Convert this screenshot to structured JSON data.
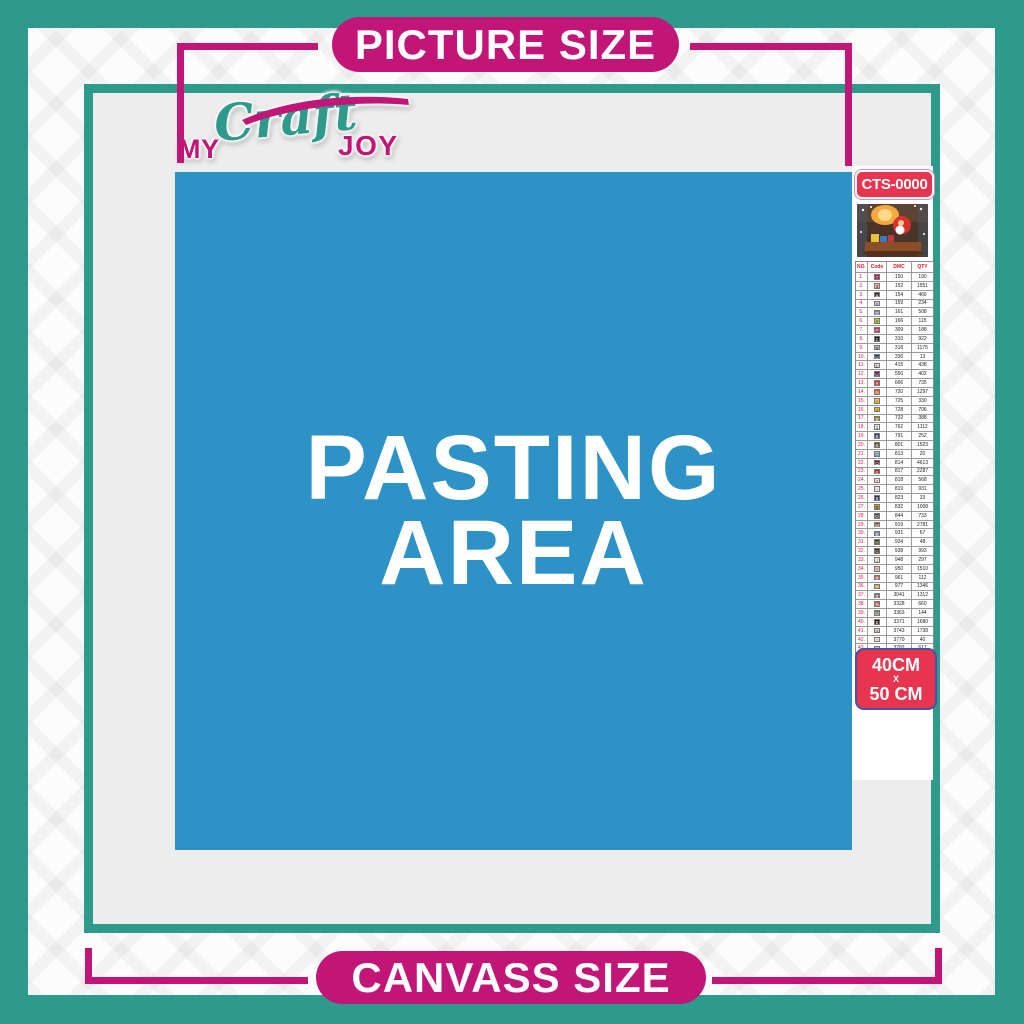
{
  "banner_top": {
    "label": "PICTURE SIZE"
  },
  "banner_bottom": {
    "label": "CANVASS SIZE"
  },
  "logo": {
    "my": "MY",
    "craft": "Craft",
    "joy": "JOY"
  },
  "pasting_area": {
    "line1": "PASTING",
    "line2": "AREA"
  },
  "sidebar": {
    "sku": "CTS-0000",
    "thumbnail_alt": "christmas-santa-sleigh-artwork",
    "size_box": {
      "line1": "40CM",
      "line2": "X",
      "line3": "50 CM"
    },
    "table": {
      "headers": [
        "NO.",
        "Code",
        "DMC",
        "QTY"
      ],
      "rows": [
        {
          "no": "1.",
          "sym": "T",
          "bg": "#a3134b",
          "fg": "#ffffff",
          "dmc": "150",
          "qty": "190"
        },
        {
          "no": "2.",
          "sym": "3",
          "bg": "#e9b3ae",
          "fg": "#5a2a33",
          "dmc": "152",
          "qty": "1551"
        },
        {
          "no": "3.",
          "sym": "a",
          "bg": "#57253e",
          "fg": "#ffffff",
          "dmc": "154",
          "qty": "466"
        },
        {
          "no": "4.",
          "sym": "X",
          "bg": "#c9cce0",
          "fg": "#555a77",
          "dmc": "159",
          "qty": "234"
        },
        {
          "no": "5.",
          "sym": "G",
          "bg": "#7f87ac",
          "fg": "#ffffff",
          "dmc": "161",
          "qty": "508"
        },
        {
          "no": "6.",
          "sym": "h",
          "bg": "#c5cf3c",
          "fg": "#4a4a10",
          "dmc": "166",
          "qty": "115"
        },
        {
          "no": "7.",
          "sym": "P",
          "bg": "#c22e53",
          "fg": "#ffffff",
          "dmc": "309",
          "qty": "188"
        },
        {
          "no": "8.",
          "sym": "E",
          "bg": "#0a0a0a",
          "fg": "#ffffff",
          "dmc": "310",
          "qty": "922"
        },
        {
          "no": "9.",
          "sym": "X",
          "bg": "#b0b1b3",
          "fg": "#3a3a3a",
          "dmc": "318",
          "qty": "1175"
        },
        {
          "no": "10.",
          "sym": "U",
          "bg": "#2a3c6e",
          "fg": "#ffffff",
          "dmc": "336",
          "qty": "13"
        },
        {
          "no": "11.",
          "sym": "L",
          "bg": "#d6d6da",
          "fg": "#3a3a3a",
          "dmc": "415",
          "qty": "438"
        },
        {
          "no": "12.",
          "sym": "U",
          "bg": "#611a56",
          "fg": "#ffffff",
          "dmc": "550",
          "qty": "402"
        },
        {
          "no": "13.",
          "sym": "#",
          "bg": "#e52c3c",
          "fg": "#ffffff",
          "dmc": "666",
          "qty": "735"
        },
        {
          "no": "14.",
          "sym": "N",
          "bg": "#e65d23",
          "fg": "#ffffff",
          "dmc": "720",
          "qty": "1297"
        },
        {
          "no": "15.",
          "sym": "A",
          "bg": "#ffc43c",
          "fg": "#6b4a00",
          "dmc": "725",
          "qty": "330"
        },
        {
          "no": "16.",
          "sym": "2",
          "bg": "#f0b83a",
          "fg": "#6b4a00",
          "dmc": "728",
          "qty": "706"
        },
        {
          "no": "17.",
          "sym": "S",
          "bg": "#9a8f22",
          "fg": "#ffffff",
          "dmc": "732",
          "qty": "388"
        },
        {
          "no": "18.",
          "sym": "1",
          "bg": "#e9e9eb",
          "fg": "#3a3a3a",
          "dmc": "762",
          "qty": "1112"
        },
        {
          "no": "19.",
          "sym": "B",
          "bg": "#3c3a75",
          "fg": "#ffffff",
          "dmc": "791",
          "qty": "252"
        },
        {
          "no": "20.",
          "sym": "B",
          "bg": "#6a4528",
          "fg": "#ffffff",
          "dmc": "801",
          "qty": "1523"
        },
        {
          "no": "21.",
          "sym": "O",
          "bg": "#a8c6de",
          "fg": "#2a4a66",
          "dmc": "813",
          "qty": "20"
        },
        {
          "no": "22.",
          "sym": "O",
          "bg": "#750b24",
          "fg": "#ffffff",
          "dmc": "814",
          "qty": "4613"
        },
        {
          "no": "23.",
          "sym": "E",
          "bg": "#c01f23",
          "fg": "#ffffff",
          "dmc": "817",
          "qty": "2287"
        },
        {
          "no": "24.",
          "sym": "7",
          "bg": "#ffdfdb",
          "fg": "#8a4a4a",
          "dmc": "818",
          "qty": "568"
        },
        {
          "no": "25.",
          "sym": "+",
          "bg": "#f9ebe9",
          "fg": "#8a5a5a",
          "dmc": "819",
          "qty": "931"
        },
        {
          "no": "26.",
          "sym": "B",
          "bg": "#22315f",
          "fg": "#ffffff",
          "dmc": "823",
          "qty": "33"
        },
        {
          "no": "27.",
          "sym": "B",
          "bg": "#c09c3f",
          "fg": "#4a3a00",
          "dmc": "832",
          "qty": "1008"
        },
        {
          "no": "28.",
          "sym": "O",
          "bg": "#4a4a4a",
          "fg": "#ffffff",
          "dmc": "844",
          "qty": "733"
        },
        {
          "no": "29.",
          "sym": "M",
          "bg": "#a6462a",
          "fg": "#ffffff",
          "dmc": "919",
          "qty": "2781"
        },
        {
          "no": "30.",
          "sym": "S",
          "bg": "#6f90ab",
          "fg": "#ffffff",
          "dmc": "931",
          "qty": "67"
        },
        {
          "no": "31.",
          "sym": "H",
          "bg": "#3a4020",
          "fg": "#ffffff",
          "dmc": "934",
          "qty": "48"
        },
        {
          "no": "32.",
          "sym": "G",
          "bg": "#3c2613",
          "fg": "#ffffff",
          "dmc": "938",
          "qty": "993"
        },
        {
          "no": "33.",
          "sym": "J",
          "bg": "#fde9da",
          "fg": "#8a5a3a",
          "dmc": "948",
          "qty": "297"
        },
        {
          "no": "34.",
          "sym": "*",
          "bg": "#e6c0aa",
          "fg": "#7a4a2a",
          "dmc": "950",
          "qty": "1510"
        },
        {
          "no": "35.",
          "sym": "#",
          "bg": "#d06b80",
          "fg": "#ffffff",
          "dmc": "961",
          "qty": "112"
        },
        {
          "no": "36.",
          "sym": "T",
          "bg": "#dc9e58",
          "fg": "#ffffff",
          "dmc": "977",
          "qty": "1346"
        },
        {
          "no": "37.",
          "sym": "2",
          "bg": "#94788b",
          "fg": "#ffffff",
          "dmc": "3041",
          "qty": "1312"
        },
        {
          "no": "38.",
          "sym": "%",
          "bg": "#c65966",
          "fg": "#ffffff",
          "dmc": "3328",
          "qty": "660"
        },
        {
          "no": "39.",
          "sym": "U",
          "bg": "#77865e",
          "fg": "#ffffff",
          "dmc": "3363",
          "qty": "144"
        },
        {
          "no": "40.",
          "sym": "B",
          "bg": "#241307",
          "fg": "#ffffff",
          "dmc": "3371",
          "qty": "1680"
        },
        {
          "no": "41.",
          "sym": "Y",
          "bg": "#dcd1dc",
          "fg": "#4a3a4a",
          "dmc": "3743",
          "qty": "1738"
        },
        {
          "no": "42.",
          "sym": "^",
          "bg": "#ffeee3",
          "fg": "#8a6a4a",
          "dmc": "3770",
          "qty": "40"
        },
        {
          "no": "43.",
          "sym": "V",
          "bg": "#d4bfa5",
          "fg": "#5a4a2a",
          "dmc": "3782",
          "qty": "617"
        },
        {
          "no": "44.",
          "sym": "2",
          "bg": "#dfe269",
          "fg": "#4a5a10",
          "dmc": "3819",
          "qty": "119"
        },
        {
          "no": "45.",
          "sym": "/",
          "bg": "#fdf6d3",
          "fg": "#8a8a3a",
          "dmc": "3823",
          "qty": "107"
        },
        {
          "no": "46.",
          "sym": "C",
          "bg": "#ef9b52",
          "fg": "#ffffff",
          "dmc": "3853",
          "qty": "1332"
        },
        {
          "no": "47.",
          "sym": "B",
          "bg": "#7a4441",
          "fg": "#ffffff",
          "dmc": "3858",
          "qty": "2311"
        },
        {
          "no": "48.",
          "sym": "A",
          "bg": "#a98866",
          "fg": "#ffffff",
          "dmc": "3863",
          "qty": "1820"
        }
      ]
    }
  },
  "colors": {
    "teal": "#2e9a8b",
    "magenta": "#c11577",
    "blue": "#2d92c5",
    "red": "#e7354f",
    "content_gray": "#ededed"
  }
}
